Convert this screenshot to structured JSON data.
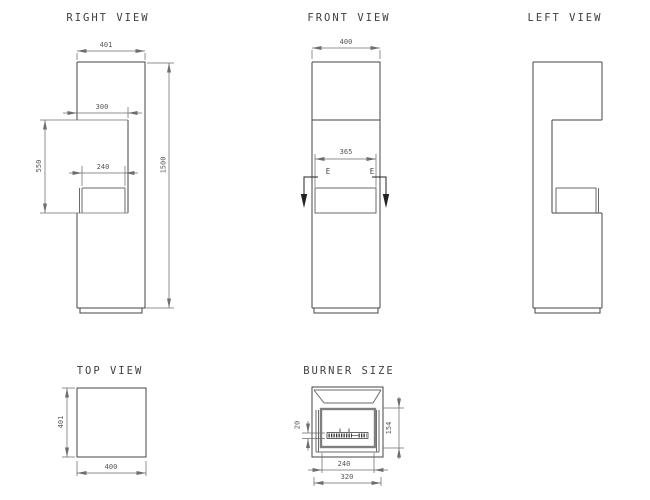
{
  "drawing": {
    "type": "technical-drawing",
    "subject": "ethanol burner fireplace column",
    "colors": {
      "background": "#ffffff",
      "outline": "#454545",
      "dimension_line": "#6e6e6e",
      "dimension_text": "#555555",
      "title_text": "#3f3f3f",
      "section_marker": "#222222",
      "tray_border": "#808080"
    },
    "views": {
      "right": {
        "title": "RIGHT VIEW",
        "dims": {
          "width": "401",
          "opening_depth": "300",
          "opening_height": "550",
          "burner_depth": "240",
          "total_height": "1500"
        }
      },
      "front": {
        "title": "FRONT VIEW",
        "dims": {
          "width": "400",
          "opening_width": "365"
        },
        "section_label": "E"
      },
      "left": {
        "title": "LEFT VIEW"
      },
      "top": {
        "title": "TOP VIEW",
        "dims": {
          "depth": "401",
          "width": "400"
        }
      },
      "burner": {
        "title": "BURNER SIZE",
        "dims": {
          "slot_height": "20",
          "burner_height": "154",
          "inner_width": "240",
          "outer_width": "320"
        }
      }
    }
  }
}
